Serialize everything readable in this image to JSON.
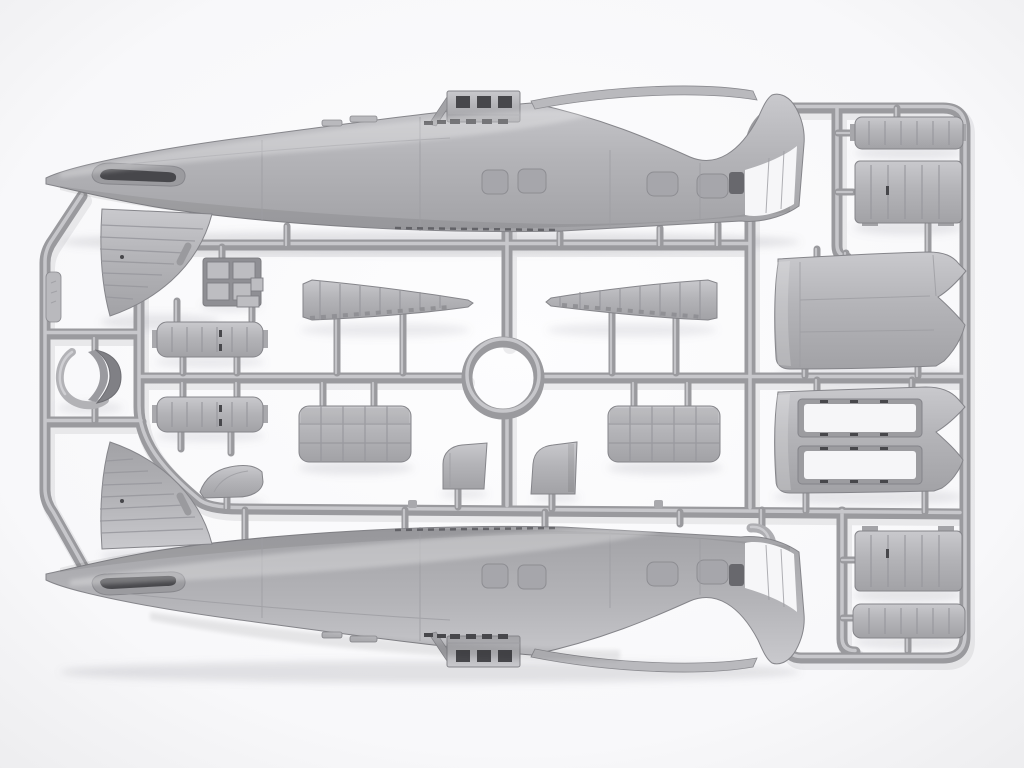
{
  "meta": {
    "title": "Gray injection-molded model aircraft sprue on white background",
    "kind": "product photo"
  },
  "colors": {
    "background": "#fbfbfc",
    "background_edge": "#ededef",
    "plastic_light": "#cdcdd1",
    "plastic_base": "#b4b4b8",
    "plastic_dark": "#a0a0a4",
    "runner": "#9a9a9e",
    "runner_highlight": "#c7c7cb",
    "detail_dark": "#47474b",
    "window_recess": "#a6a6ab",
    "cutout_white": "#f6f6f8",
    "shadow": "#82828c"
  },
  "parts": {
    "frame": {
      "label": "Sprue runner frame"
    },
    "ring": {
      "label": "Central sprue ring"
    },
    "fuselage_top": {
      "label": "Fuselage half, left side"
    },
    "fuselage_bottom": {
      "label": "Fuselage half, right side"
    },
    "slat_left": {
      "label": "Tapered wing leading-edge section, left"
    },
    "slat_right": {
      "label": "Tapered wing leading-edge section, right"
    },
    "radiator_left": {
      "label": "Radiator grille panel, left"
    },
    "radiator_right": {
      "label": "Radiator grille panel, right"
    },
    "bay_door_upper": {
      "label": "Ribbed bay door, upper"
    },
    "bay_door_lower": {
      "label": "Ribbed bay door, lower"
    },
    "equipment_boxes": {
      "label": "Equipment box cluster"
    },
    "cowl_ring": {
      "label": "Engine cowl ring with saddle"
    },
    "brand_tag": {
      "label": "Molded tag on frame rail"
    },
    "wedge_left": {
      "label": "Small fairing wedge, left"
    },
    "wedge_right": {
      "label": "Small fairing wedge, right"
    },
    "fairing_hump": {
      "label": "Small fairing hump"
    },
    "hook_bracket": {
      "label": "Curved bracket"
    },
    "wing_panel_solid": {
      "label": "Wing center-section panel"
    },
    "wing_panel_openings": {
      "label": "Wing panel with bay openings"
    },
    "ribbed_block_a": {
      "label": "Ribbed hatch part A"
    },
    "ribbed_block_b": {
      "label": "Ribbed hatch part B"
    },
    "ribbed_block_c": {
      "label": "Ribbed hatch part C"
    },
    "ribbed_block_d": {
      "label": "Ribbed hatch part D"
    }
  }
}
